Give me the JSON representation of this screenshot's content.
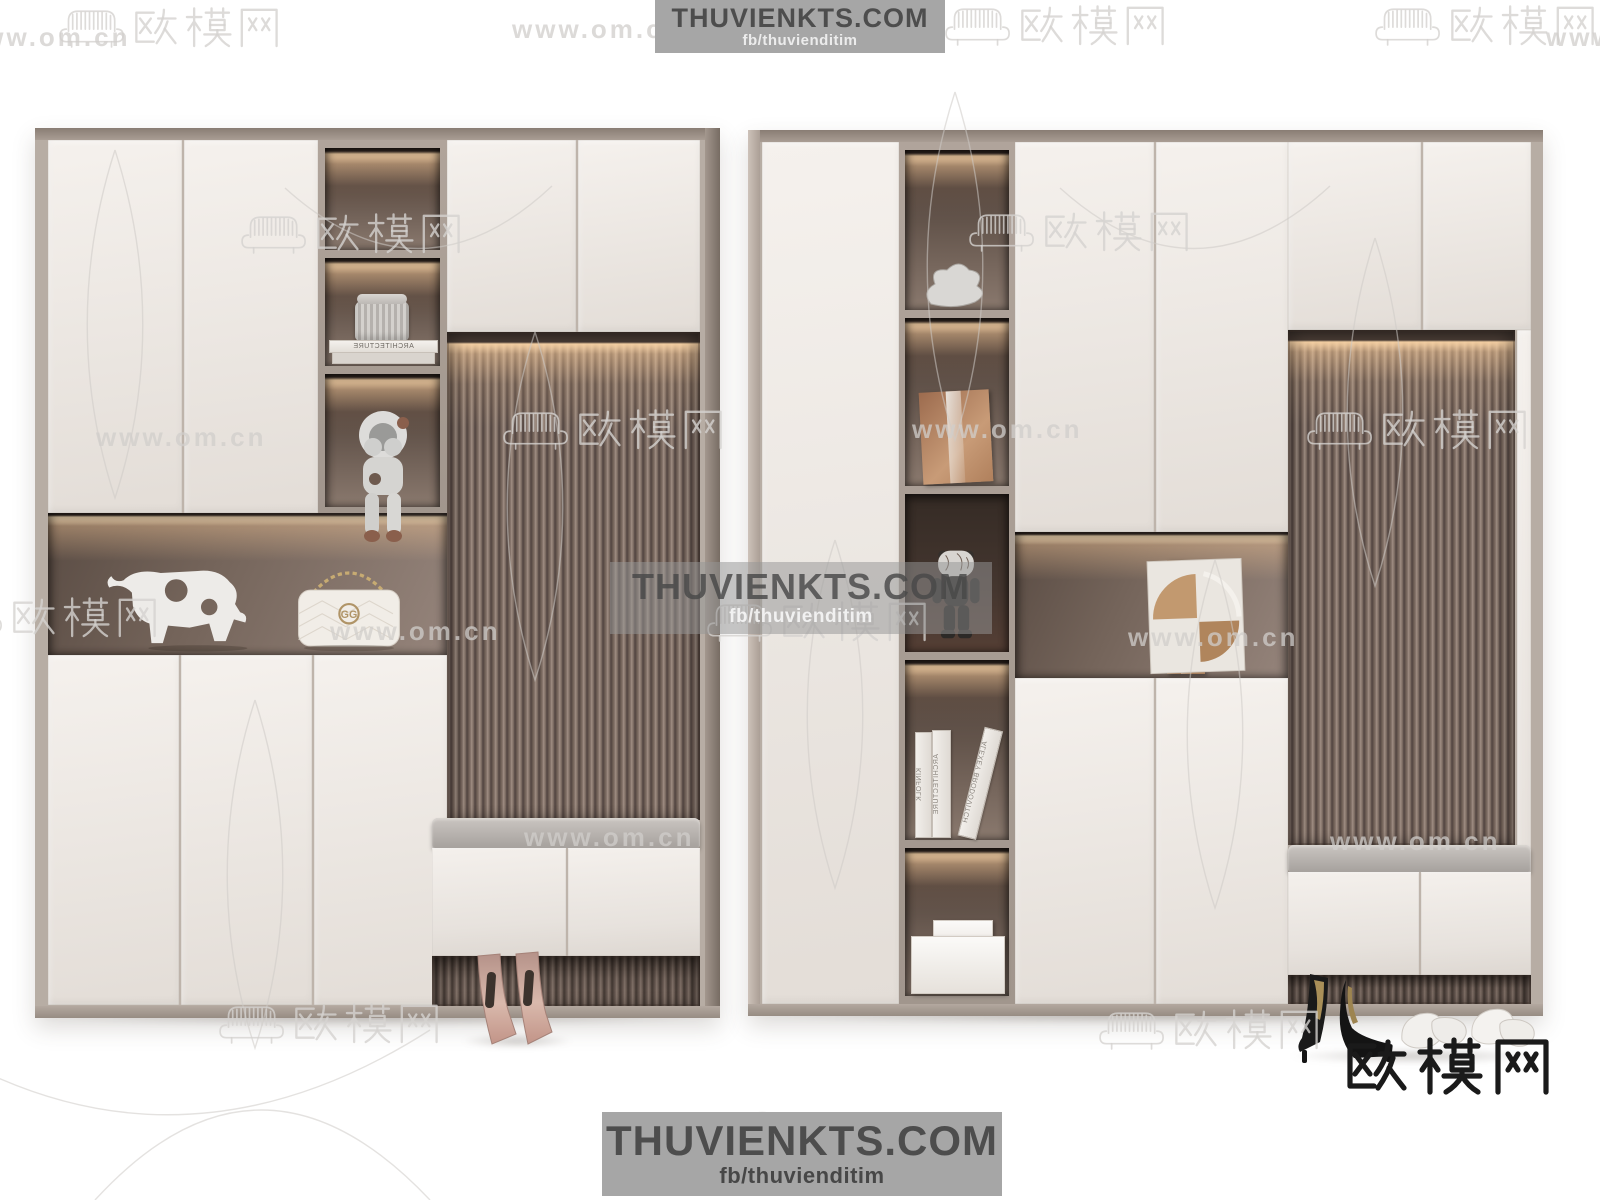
{
  "banners": {
    "top": {
      "title": "THUVIENKTS.COM",
      "subtitle": "fb/thuvienditim"
    },
    "center": {
      "title": "THUVIENKTS.COM",
      "subtitle": "fb/thuvienditim"
    },
    "bottom": {
      "title": "THUVIENKTS.COM",
      "subtitle": "fb/thuvienditim"
    }
  },
  "watermark": {
    "url": "www.om.cn",
    "brand": "欧模网"
  },
  "logo": {
    "text": "欧模网"
  },
  "decor": {
    "book_spine_left": "ARCHITECTURE",
    "books_right": [
      "KINFOLK",
      "ARCHITECTURE",
      "ALEXEY BRODOVITCH"
    ],
    "bag_monogram": "GG"
  },
  "colors": {
    "door": "#f0ece7",
    "frame": "#b5aba2",
    "flute_dark": "#574a42",
    "flute_light": "#97867c",
    "niche": "#7d6c62",
    "glow": "#eec69c",
    "cushion": "#b7b2ae",
    "banner_bg": "#a6a6a6",
    "banner_text": "#4d4d4d",
    "logo_text": "#1a1a1a"
  }
}
